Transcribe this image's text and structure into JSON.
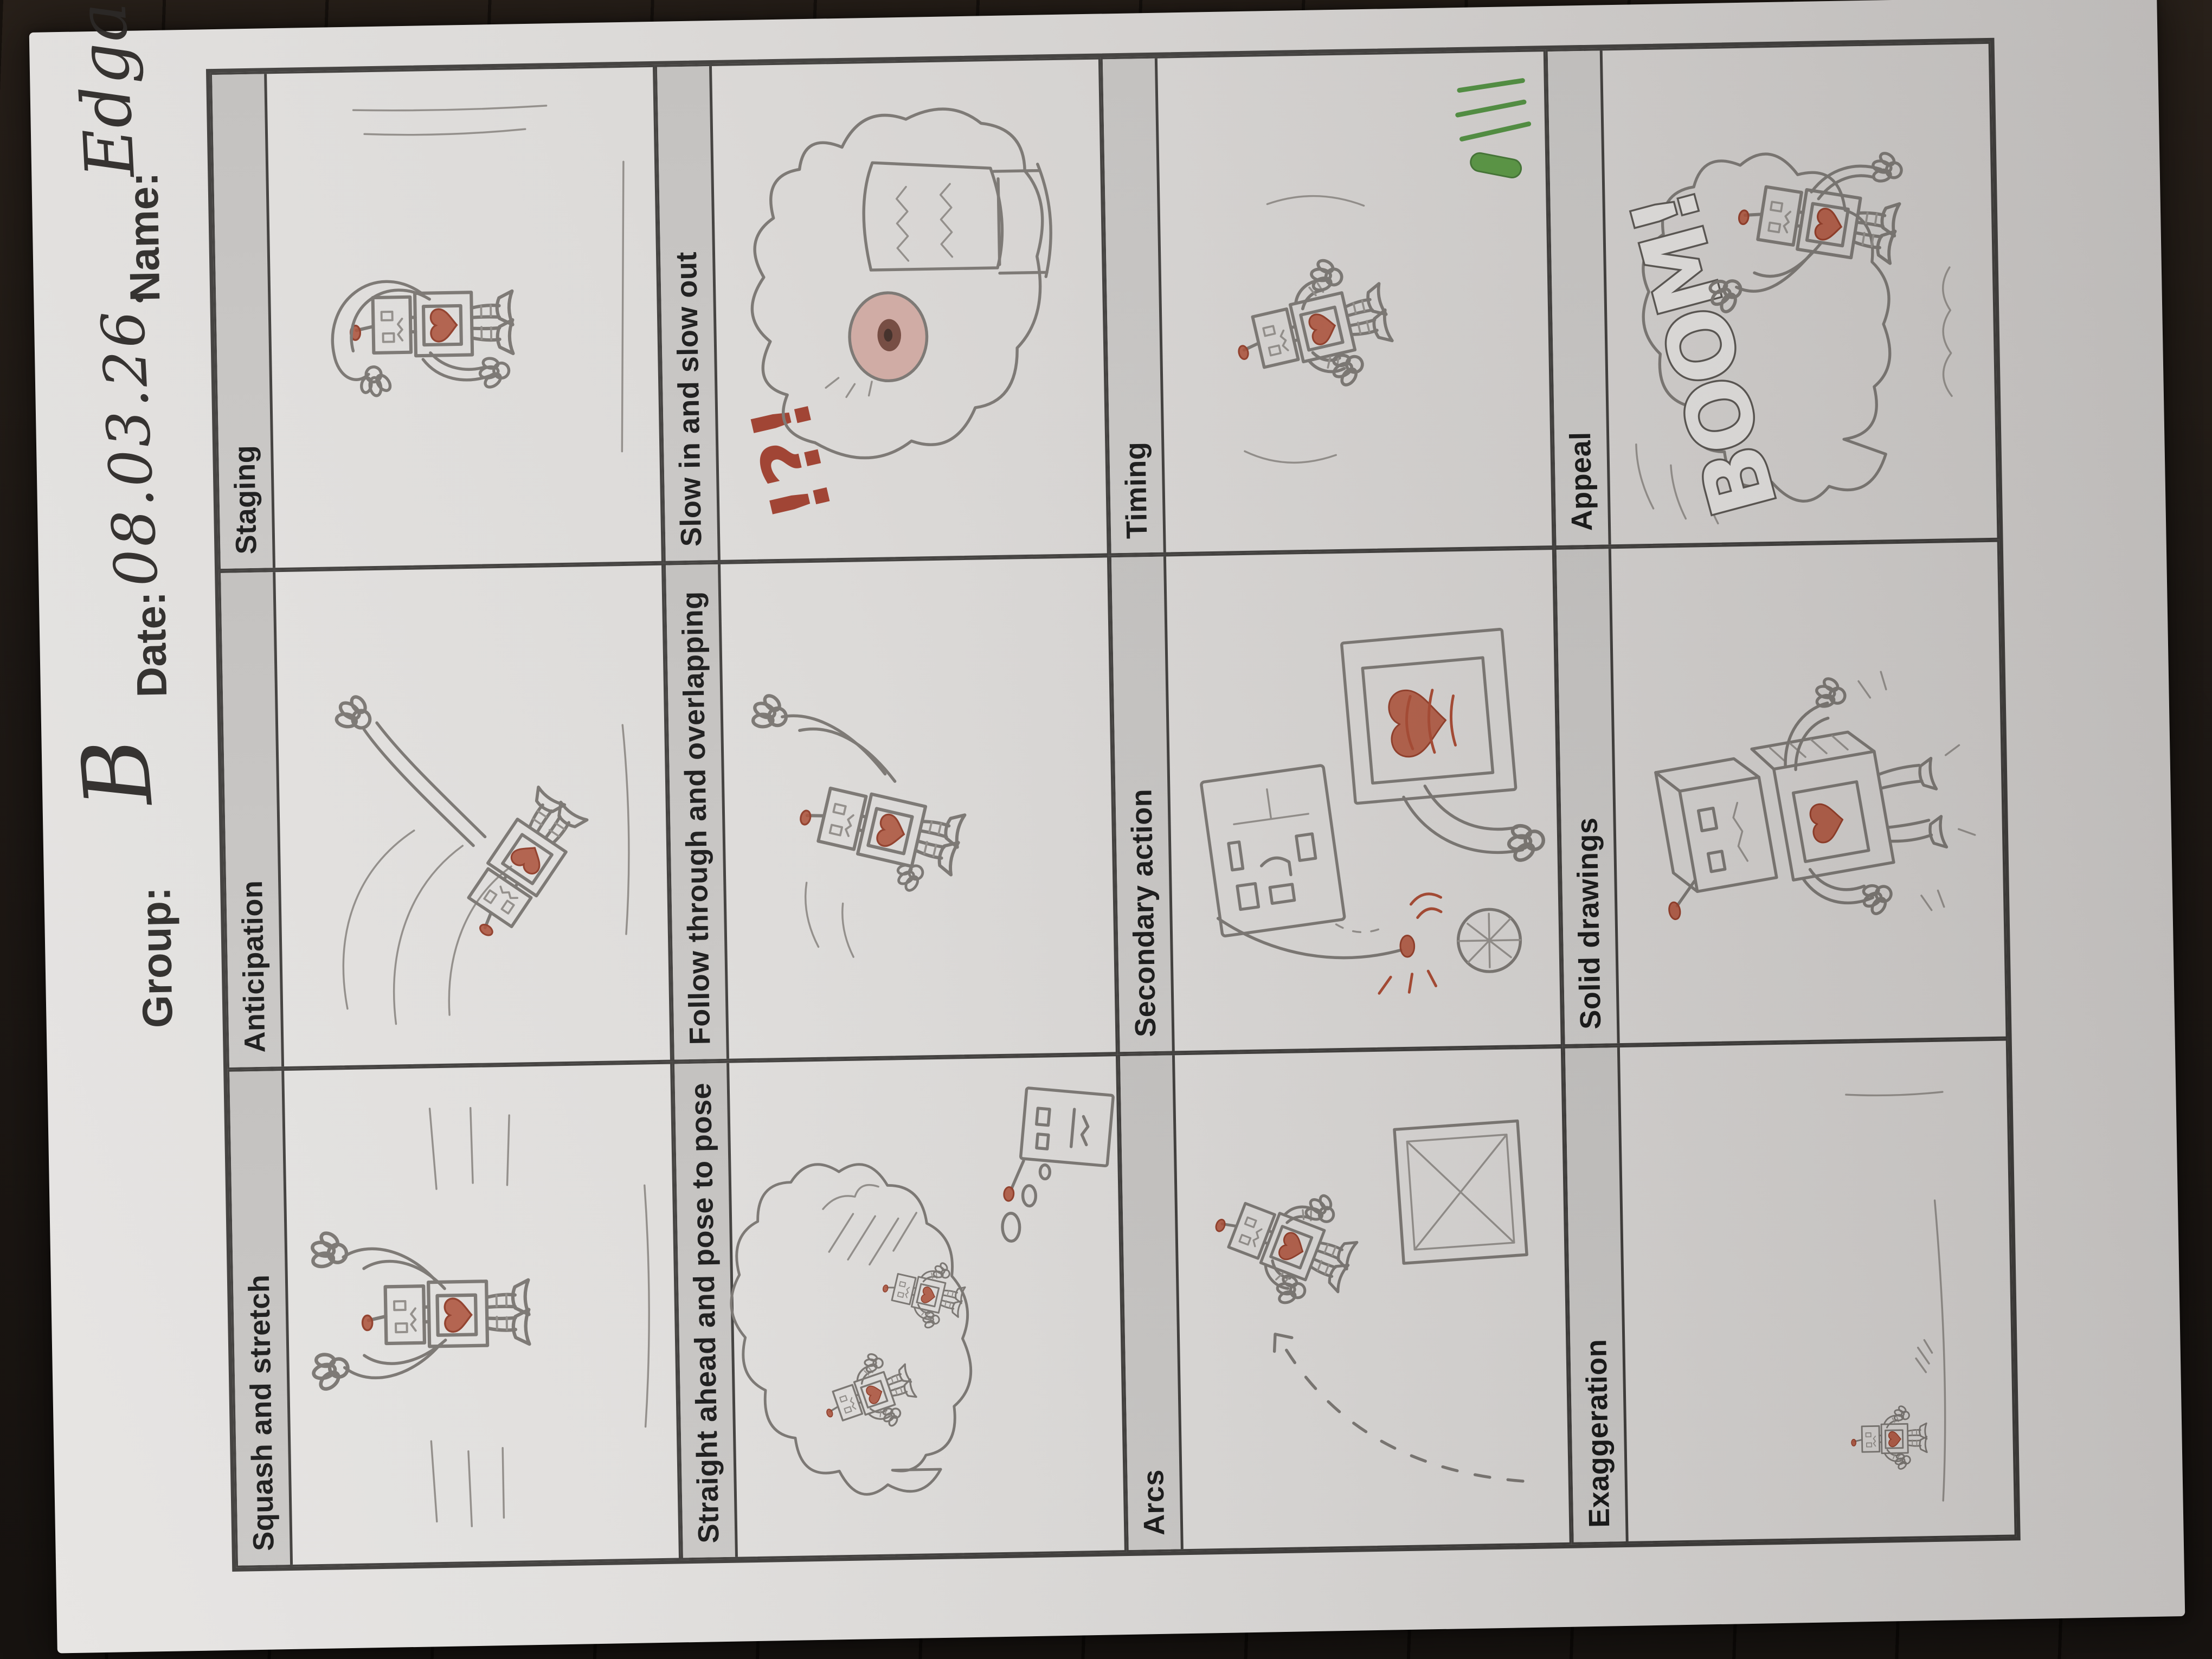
{
  "header": {
    "group_label": "Group:",
    "group_value": "B",
    "date_label": "Date:",
    "date_value": "08.03.26.",
    "name_label": "Name:",
    "name_value": "Edgars Vītols"
  },
  "annotations": {
    "interrobang": "!?!",
    "boom": "BOOM!"
  },
  "colors": {
    "paper": "#d9d7d5",
    "band_gray": "#c5c3c1",
    "border_dark": "#3c3a38",
    "pencil": "#77736f",
    "accent_red": "#a84b33",
    "accent_green": "#4c8a3c",
    "table_wood": "#1a1410"
  },
  "grid": {
    "cells": [
      {
        "label": "Squash and stretch",
        "sketch": "pencil robot stretching tall, both segmented arms raised high with mitten hands, red heart on chest panel, horizontal motion lines"
      },
      {
        "label": "Anticipation",
        "sketch": "pencil robot crouched leaning forward ready to dash, one arm thrown up behind, swoosh arcs, red heart on chest"
      },
      {
        "label": "Staging",
        "sketch": "pencil robot standing centered, one tube arm arched over its head, antenna with red tip, heart panel, ground line"
      },
      {
        "label": "Straight ahead and pose to pose",
        "sketch": "robot head thinking with bubble trail to a large thought cloud containing two small robot poses and scribbles"
      },
      {
        "label": "Follow through and overlapping",
        "sketch": "robot skidding to a stop leaning back, one arm whipping up with spread hand, red heart on chest"
      },
      {
        "label": "Slow in and slow out",
        "sketch": "big screaming robot monster face with one large eye, zigzag teeth, wild flame hair, red !?! above"
      },
      {
        "label": "Arcs",
        "sketch": "dashed arc trajectory with arrow, robot leaping along the arc over a wooden crate marked with an X"
      },
      {
        "label": "Secondary action",
        "sketch": "close-up robot with button panel head, large scribbled red heart panel, antenna drooping to the ground with red sparks, hatched disc"
      },
      {
        "label": "Timing",
        "sketch": "robot tumbling mid-air with limbs spread, green pen streaks and capsule at the lower right crossing the border"
      },
      {
        "label": "Exaggeration",
        "sketch": "tiny robot with red antenna tip standing alone near the bottom left of a huge empty frame on a faint ground line"
      },
      {
        "label": "Solid drawings",
        "sketch": "robot drawn with 3D cube head and cube body in perspective, hatching on side faces, impact dashes"
      },
      {
        "label": "Appeal",
        "sketch": "robot waving from a big explosion cloud with large outlined bubble letters BOOM!"
      }
    ]
  }
}
